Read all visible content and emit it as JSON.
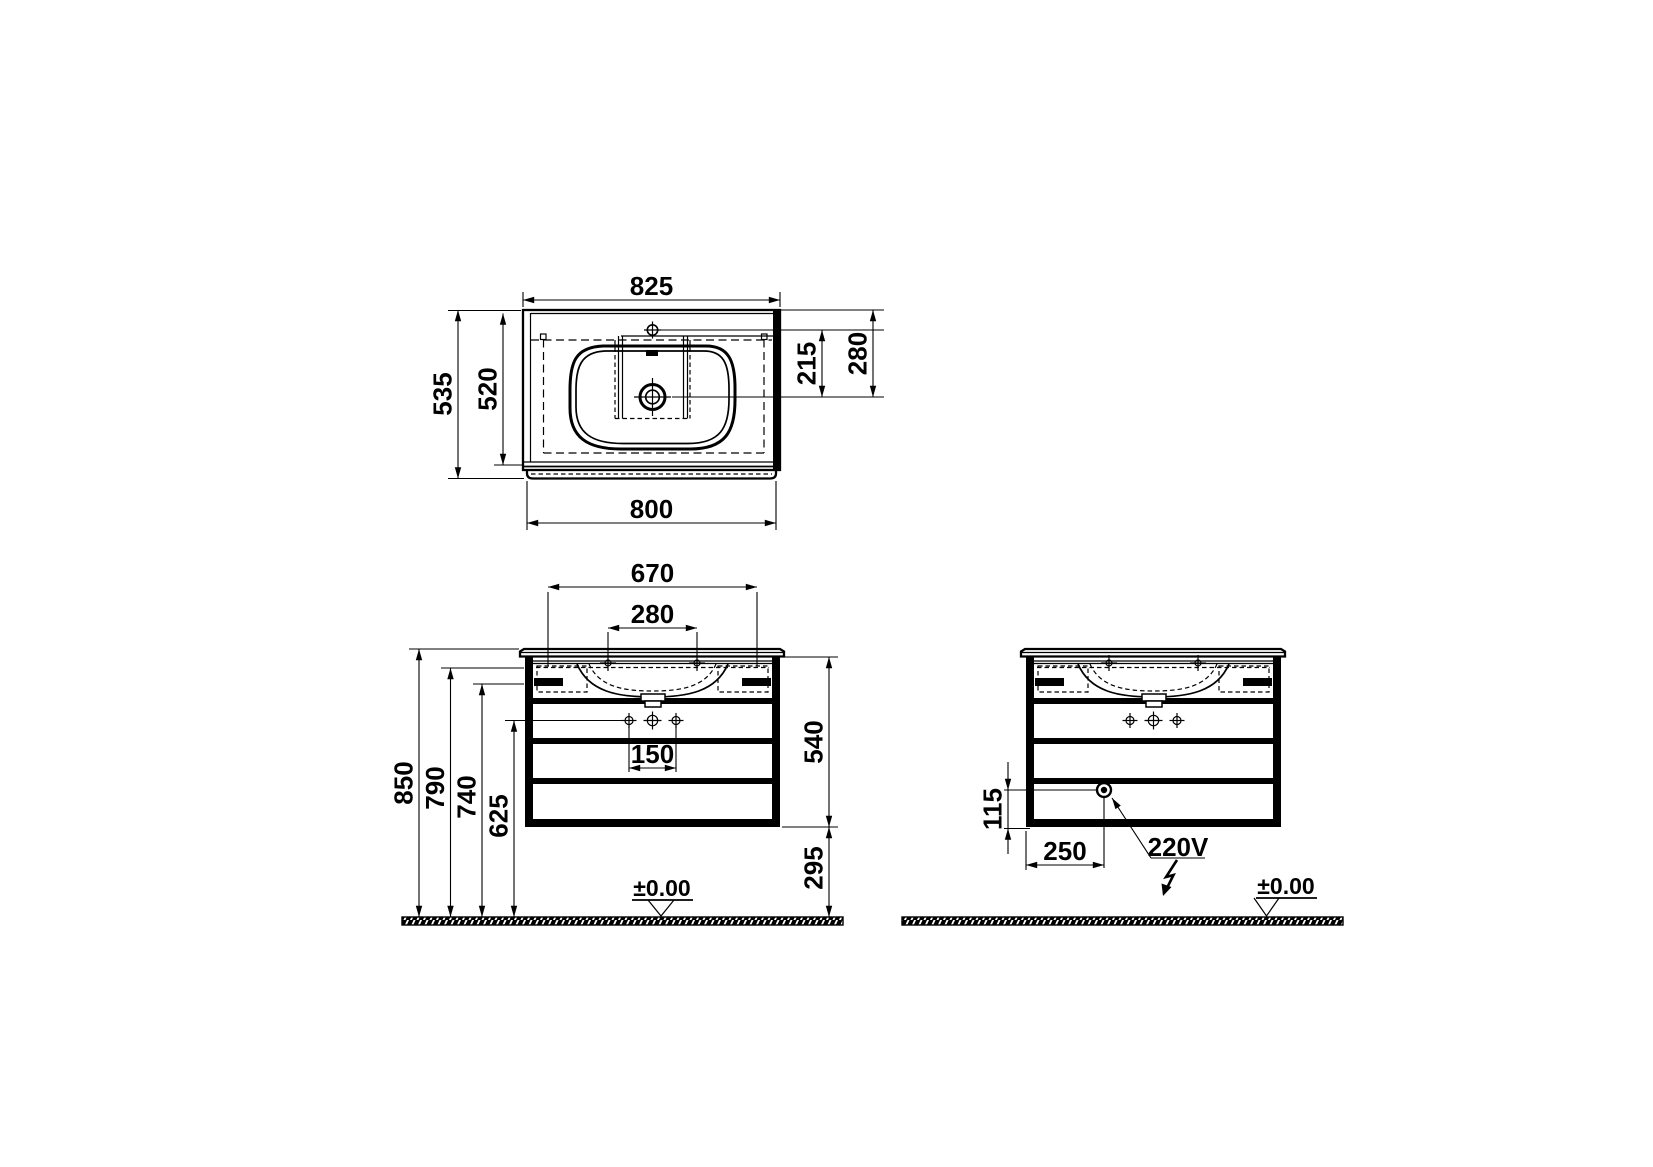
{
  "document": {
    "type": "technical-installation-drawing",
    "subject": "vanity unit with washbasin",
    "line_color": "#000000",
    "background_color": "#ffffff"
  },
  "views": {
    "plan": {
      "title": "plan view (washbasin top)",
      "dims": {
        "top_width": "825",
        "side_depth": "535",
        "inner_depth": "520",
        "tap_to_drain": "215",
        "edge_to_drain": "280",
        "bottom_width": "800"
      }
    },
    "front": {
      "title": "front view (cabinet with drawers)",
      "dims": {
        "basin_width": "670",
        "tap_spacing": "280",
        "handle_spacing": "150",
        "height_total": "850",
        "height_rim": "790",
        "height_under": "740",
        "height_handles": "625",
        "cabinet_height": "540",
        "floor_gap": "295"
      },
      "ground": "±0.00"
    },
    "electric": {
      "title": "front view (electrical connection)",
      "dims": {
        "socket_up": "115",
        "socket_side": "250"
      },
      "label": "220V",
      "ground": "±0.00"
    }
  }
}
